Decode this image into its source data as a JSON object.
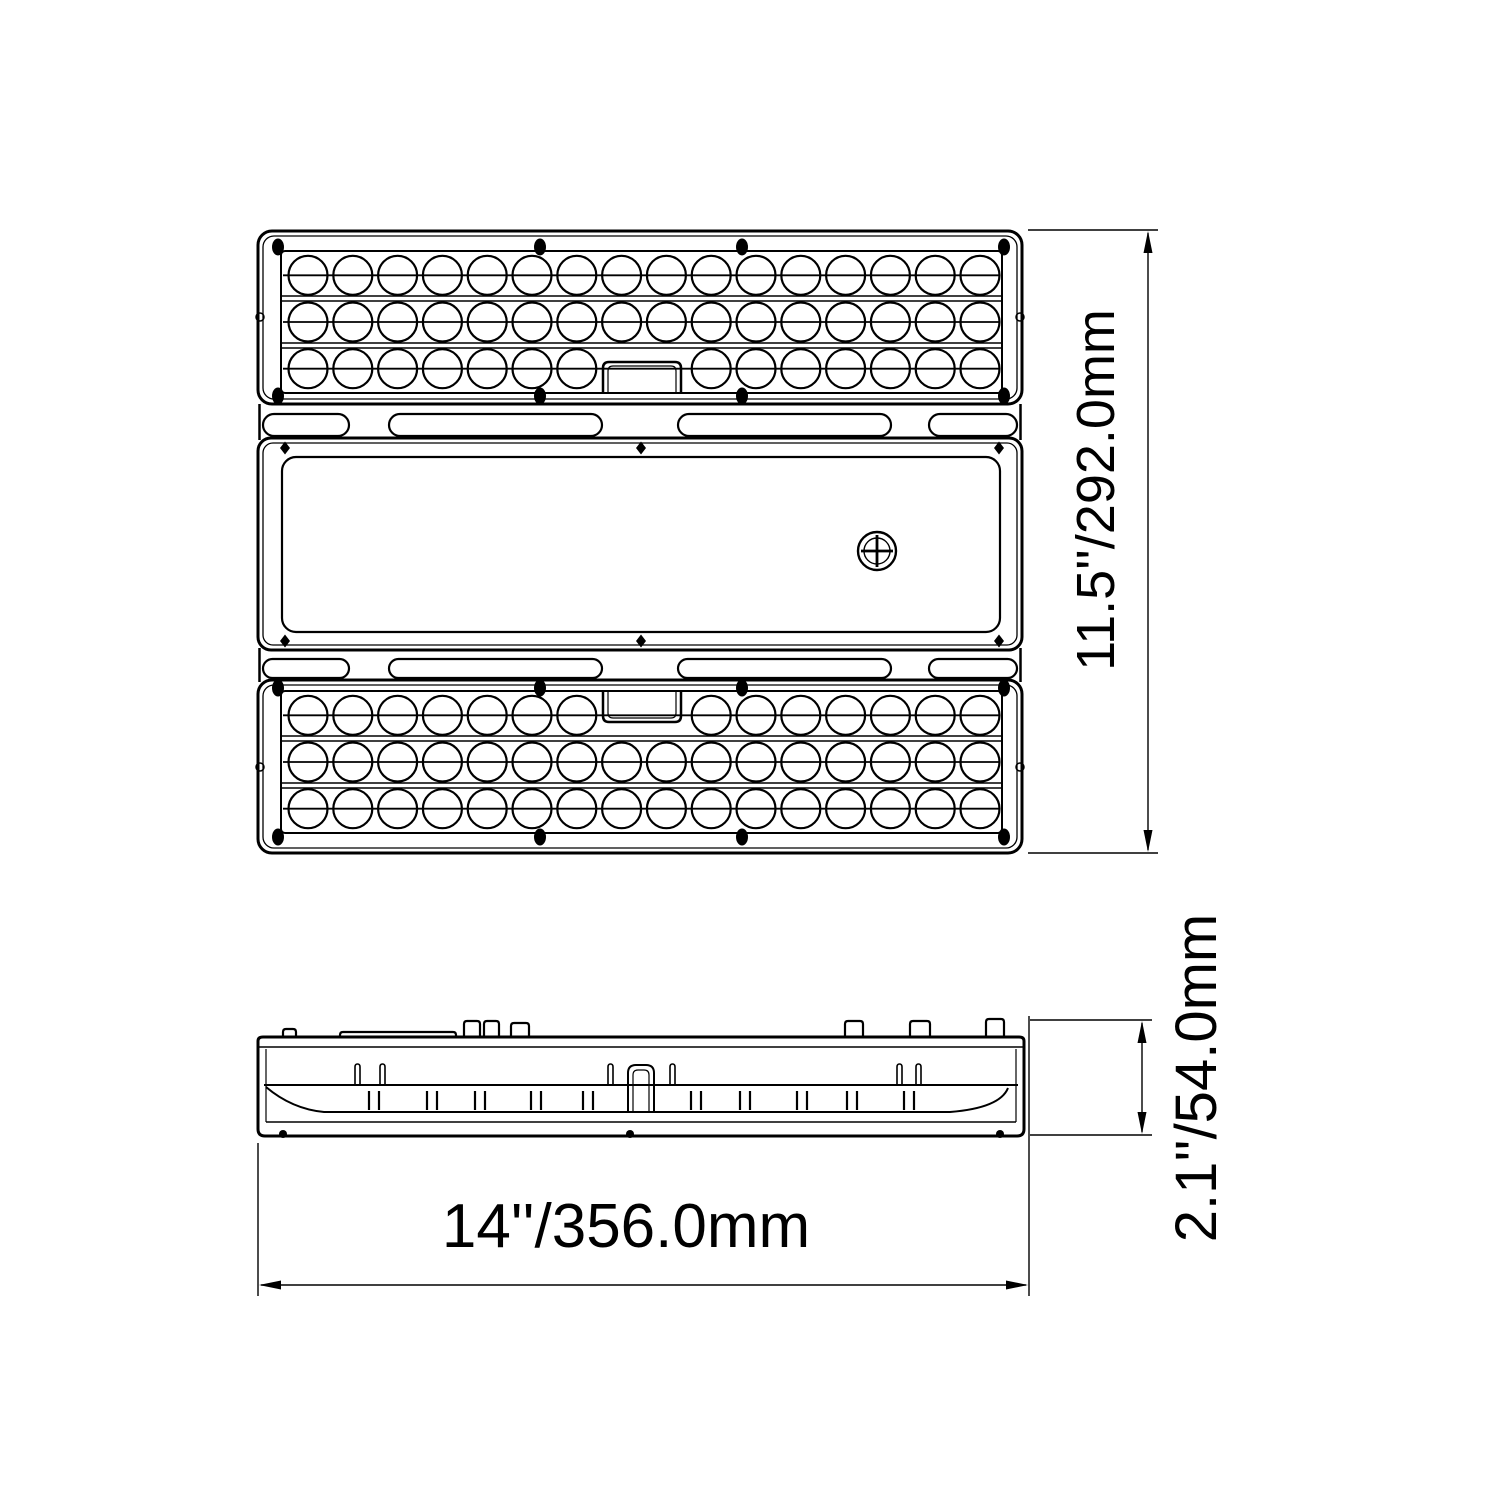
{
  "drawing": {
    "background": "#ffffff",
    "line_color": "#000000"
  },
  "dimensions": {
    "height": {
      "label": "11.5''/292.0mm"
    },
    "width": {
      "label": "14''/356.0mm"
    },
    "depth": {
      "label": "2.1''/54.0mm"
    }
  },
  "led_panel": {
    "panel_count": 2,
    "rows": 3,
    "cols": 16,
    "notched_row_skipped_cols": [
      7,
      8
    ]
  }
}
